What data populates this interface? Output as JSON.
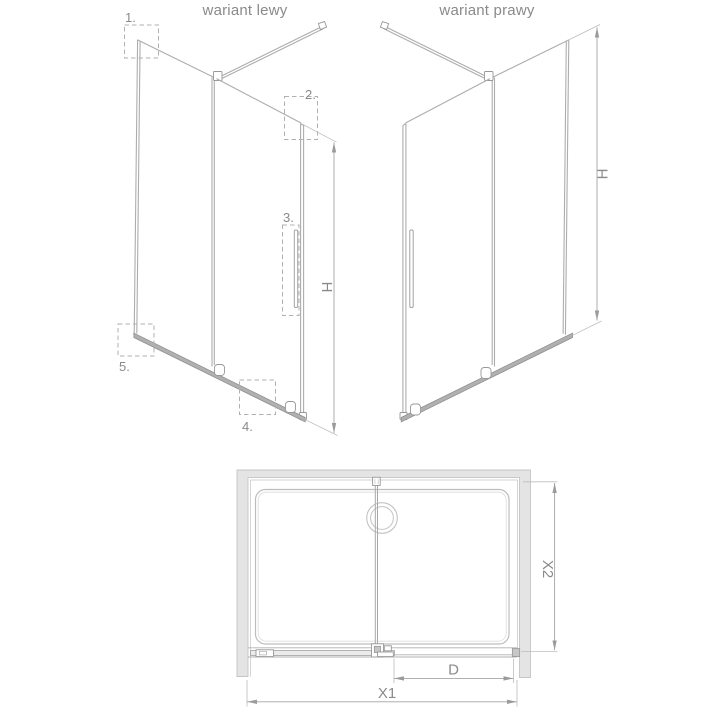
{
  "titles": {
    "left": "wariant lewy",
    "right": "wariant prawy"
  },
  "callouts": {
    "n1": "1.",
    "n2": "2.",
    "n3": "3.",
    "n4": "4.",
    "n5": "5."
  },
  "dimensions": {
    "h_left": "H",
    "h_right": "H",
    "x1": "X1",
    "x2": "X2",
    "d": "D"
  },
  "colors": {
    "line": "#adadad",
    "text": "#8a8a8a",
    "wall_fill": "#e4e4e4",
    "rail_fill": "#b0b0b0",
    "background": "#ffffff"
  }
}
